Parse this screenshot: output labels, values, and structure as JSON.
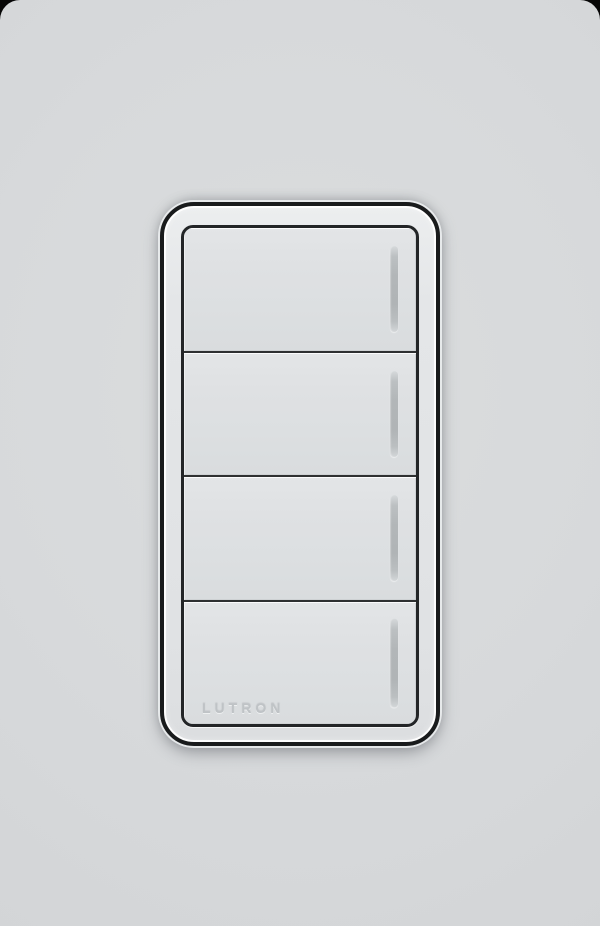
{
  "device": {
    "type": "4-button wall keypad light switch",
    "brand_label": "LUTRON",
    "buttons": [
      {
        "name": "scene-button-1",
        "label": "",
        "indicator": "led-indicator"
      },
      {
        "name": "scene-button-2",
        "label": "",
        "indicator": "led-indicator"
      },
      {
        "name": "scene-button-3",
        "label": "",
        "indicator": "led-indicator"
      },
      {
        "name": "scene-button-4",
        "label": "",
        "indicator": "led-indicator"
      }
    ]
  },
  "colors": {
    "wall_plate": "#d7d9db",
    "bezel_face": "#e2e4e6",
    "button_face": "#dde0e2",
    "frame_ring": "#191b1c",
    "separator_line": "#2e3031",
    "led_bar": "#b2b6b8",
    "brand_text": "#bfc3c6",
    "photo_corner_background": "#060606"
  }
}
